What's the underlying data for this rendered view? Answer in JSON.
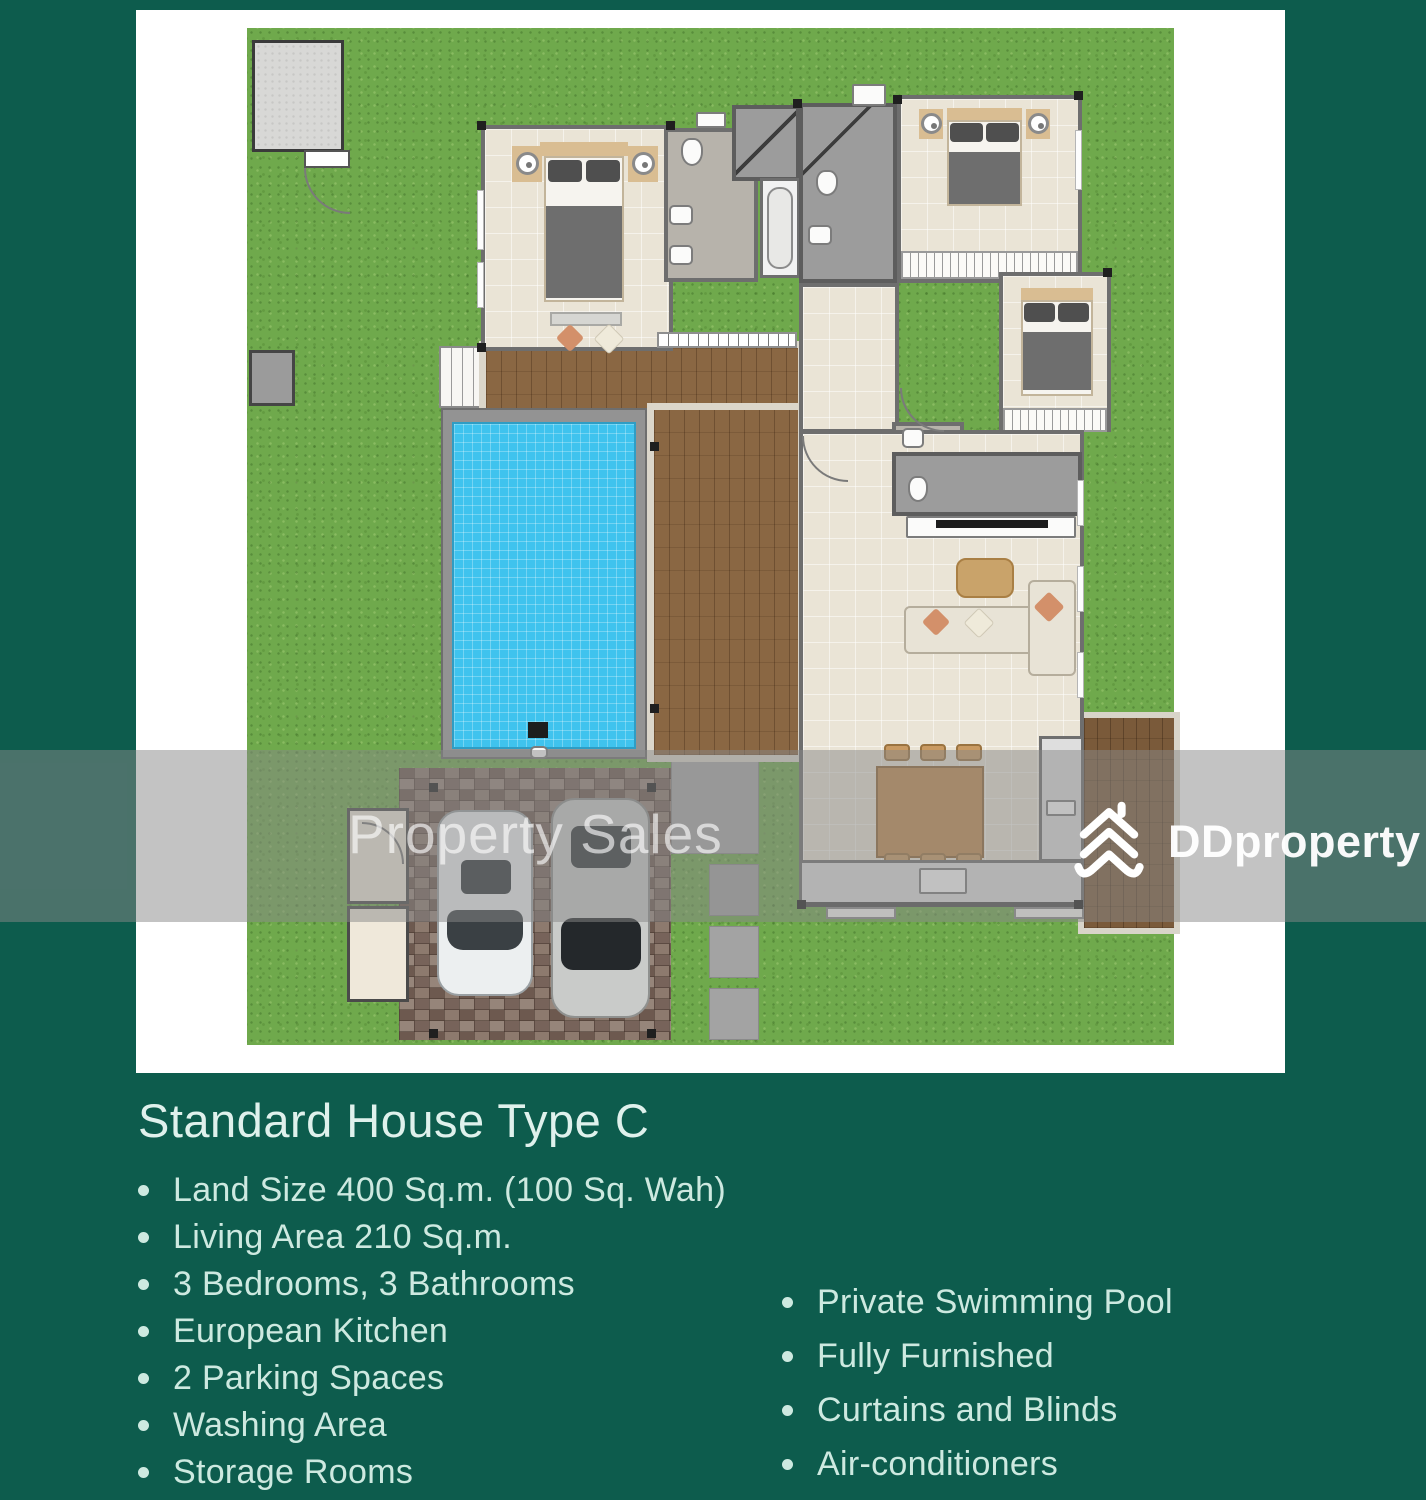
{
  "listing_card": {
    "title": "Standard House Type C",
    "features_left": [
      "Land Size 400 Sq.m. (100 Sq. Wah)",
      "Living Area 210 Sq.m.",
      "3 Bedrooms, 3 Bathrooms",
      "European Kitchen",
      "2 Parking Spaces",
      "Washing Area",
      "Storage Rooms"
    ],
    "features_right": [
      "Private Swimming Pool",
      "Fully Furnished",
      "Curtains and Blinds",
      "Air-conditioners"
    ]
  },
  "watermarks": {
    "property_sales_text": "Property Sales",
    "brand_text": "DDproperty"
  },
  "colors": {
    "background_teal": "#0d5c4d",
    "grass_green": "#6fa94c",
    "pool_water_blue": "#3fc3ee",
    "deck_wood_brown": "#86633f",
    "driveway_paver": "#84726a",
    "interior_floor_beige": "#eae4d6",
    "feature_text_mint": "#cde9e0",
    "watermark_band_grey": "rgba(136,136,136,0.5)"
  }
}
